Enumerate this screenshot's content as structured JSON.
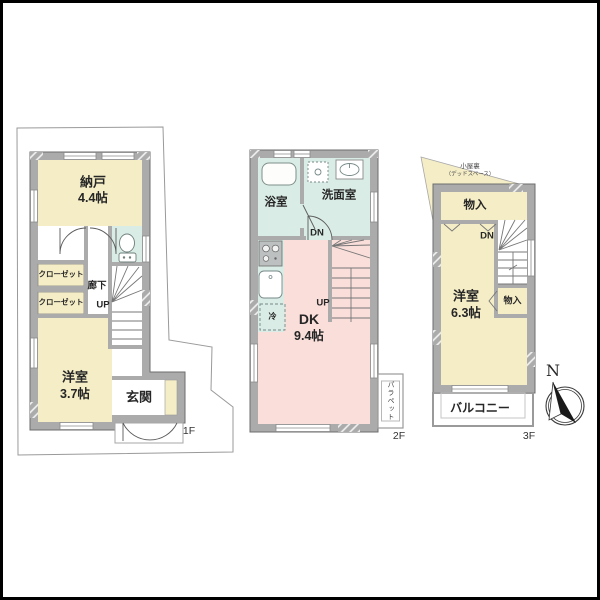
{
  "colors": {
    "room_cream": "#F4EDC6",
    "room_pink": "#F9DEDA",
    "room_aqua": "#D9ECE5",
    "wall_gray": "#ABABAB"
  },
  "icons": {
    "toilet": "toilet-icon",
    "bathtub": "bathtub-icon",
    "washing_machine": "washing-machine-icon",
    "vanity_sink": "sink-icon",
    "stove": "stove-icon",
    "kitchen_sink": "kitchen-sink-icon",
    "refrigerator": "refrigerator-box",
    "compass": "compass-rose"
  },
  "plan": {
    "floor1": {
      "floor_label": "1F",
      "storage_room": {
        "name": "納戸",
        "size": "4.4帖"
      },
      "closet_upper": "クローゼット",
      "closet_lower": "クローゼット",
      "hallway": "廊下",
      "stairs_up_label": "UP",
      "bedroom": {
        "name": "洋室",
        "size": "3.7帖"
      },
      "entrance": "玄関"
    },
    "floor2": {
      "floor_label": "2F",
      "bathroom": "浴室",
      "washroom": "洗面室",
      "stairs_down_label": "DN",
      "stairs_up_label": "UP",
      "dining_kitchen": {
        "name": "DK",
        "size": "9.4帖"
      },
      "refrigerator_label": "冷",
      "parapet": "パラペット"
    },
    "floor3": {
      "floor_label": "3F",
      "attic": {
        "line1": "小屋裏",
        "line2": "（デッドスペース）"
      },
      "storage_top": "物入",
      "storage_side": "物入",
      "stairs_down_label": "DN",
      "bedroom": {
        "name": "洋室",
        "size": "6.3帖"
      },
      "balcony": "バルコニー",
      "compass_north": "N"
    }
  }
}
